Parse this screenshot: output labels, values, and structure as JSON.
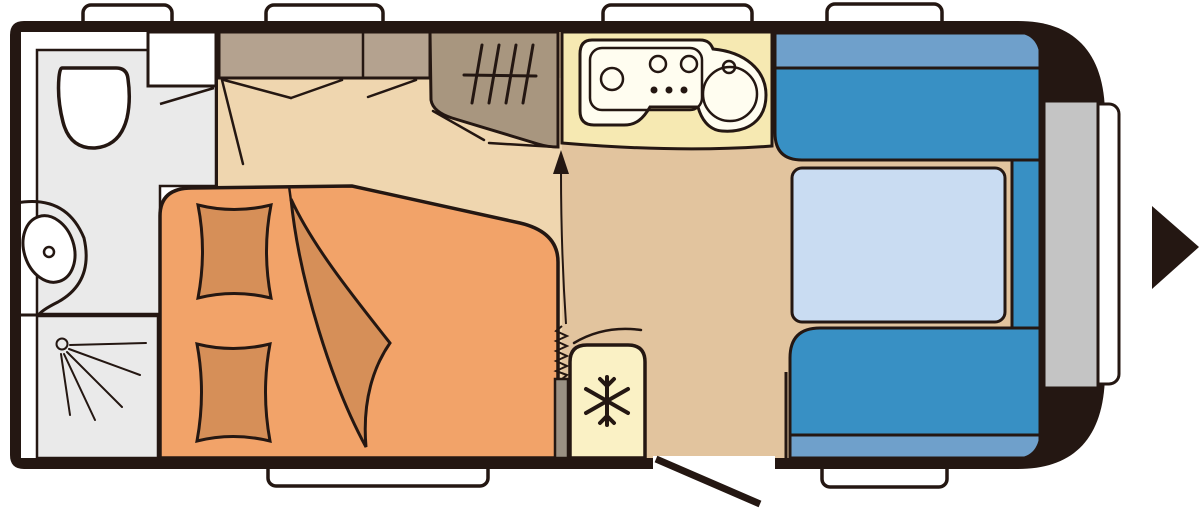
{
  "colors": {
    "wall": "#241712",
    "white": "#ffffff",
    "bathroomFloor": "#eaeaea",
    "platformFloor": "#efd6af",
    "entryFloor": "#e2c49e",
    "cabinet": "#b4a28f",
    "wardrobe": "#a8967f",
    "kitchen": "#f6e9b2",
    "hob": "#fffdf0",
    "fridge": "#faf1c5",
    "bed": "#f2a369",
    "bedding": "#d68f58",
    "seat": "#3890c4",
    "backrest": "#6fa0cb",
    "table": "#c9dcf2",
    "locker": "#c4c4c4",
    "partition": "#9a9083"
  },
  "symbols": [
    "window",
    "toilet",
    "washbasin",
    "shower",
    "overhead-cabinet",
    "wardrobe-hanging-rail",
    "double-bed",
    "pillow",
    "blanket",
    "kitchen-hob",
    "kitchen-sink",
    "fridge-snowflake",
    "entrance-door",
    "dinette-seat",
    "dinette-backrest",
    "dinette-table",
    "front-locker",
    "direction-of-travel-arrow"
  ]
}
